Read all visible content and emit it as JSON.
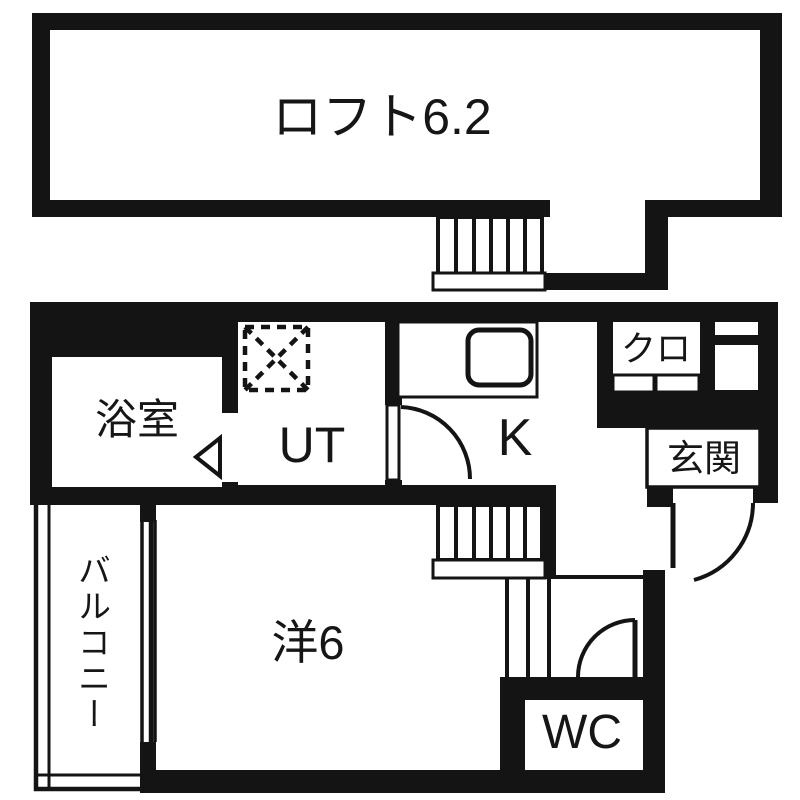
{
  "floorplan": {
    "title": "apartment-floor-plan-with-loft",
    "colors": {
      "wall": "#141414",
      "background": "#ffffff"
    },
    "rooms": {
      "loft": {
        "label": "ロフト6.2"
      },
      "bathroom": {
        "label": "浴室"
      },
      "utility": {
        "label": "UT"
      },
      "kitchen": {
        "label": "K"
      },
      "closet": {
        "label": "クロ"
      },
      "entrance": {
        "label": "玄関"
      },
      "western_room": {
        "label": "洋6"
      },
      "wc": {
        "label": "WC"
      },
      "balcony": {
        "label": "バルコニー"
      }
    }
  }
}
